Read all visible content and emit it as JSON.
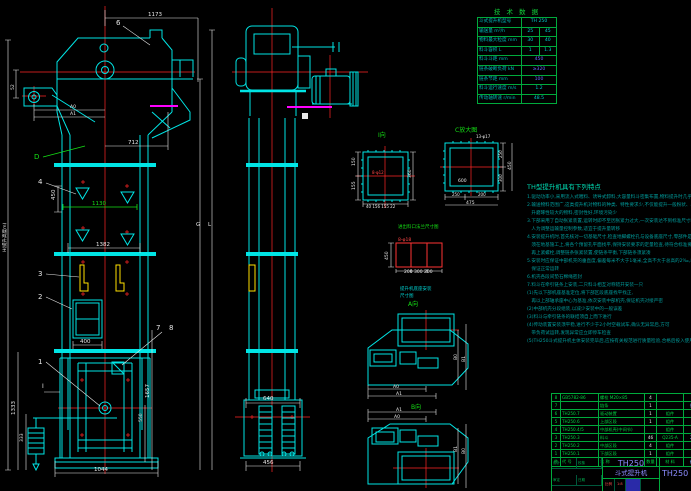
{
  "tech_table": {
    "title": "技 术 数 据",
    "rows": [
      {
        "label": "斗式提升机型号",
        "values": [
          "TH 250"
        ]
      },
      {
        "label": "输送量 m³/h",
        "values": [
          "25",
          "45"
        ]
      },
      {
        "label": "物料最大粒度 mm",
        "values": [
          "30",
          "40"
        ]
      },
      {
        "label": "料斗容积 L",
        "values": [
          "1",
          "1.3"
        ]
      },
      {
        "label": "料斗斗距 mm",
        "values": [
          "450"
        ]
      },
      {
        "label": "链条破断负荷 kN",
        "values": [
          "≥320"
        ]
      },
      {
        "label": "链条节距 mm",
        "values": [
          "100"
        ]
      },
      {
        "label": "料斗运行速度 m/s",
        "values": [
          "1.2"
        ]
      },
      {
        "label": "传动轴转速 r/min",
        "values": [
          "48.5"
        ]
      }
    ]
  },
  "notes": {
    "title": "TH型提升机具有下列特点",
    "lines": [
      "1.驱动功率小,采用流入式喂料、诱导式卸料,大容量料斗密集布置,物料提升时几乎无回流一般",
      "2.输送物料范围广,这类提升机对物料的种类、特性要求少,不仅能提升一般粉状、小颗粒状物料,而且可提",
      "   升磨琢性较大的物料,密封性好,环境污染少",
      "3.下部采用了自动张紧装置,运转时即不至因张紧力过大,一次安装达不到标准尺寸时,方可进行修正,",
      "   人为调整运输量控制参数,适宜于提升量转移",
      "4.安装提升机时,首先核对一切基础尺寸,检查地脚螺栓孔与设备底座尺寸,零部件是否齐全,附属件安装时",
      "   须在地基施工上,将各个预留孔平面找平,保持安装要求的定量检查,待符合标准要求后方可施工,",
      "   再上紧螺栓,调整链条张紧装置,使链条平衡,下部链条须紧凑",
      "5.安装时应保证中部机壳的垂直度,偏差每米不大于1毫米,全高不大于总高的2‰,以",
      "   保证正常运转",
      "6.机壳各段间垫石棉绳密封",
      "7.料斗在牵引链条上安装,二只料斗相互对称错开安装一只",
      "",
      "(1)先以下部机座基准定位,将下部区段底座找平找正,",
      "   再以上部轴承座中心为基准,依次安装中部机壳,保证机壳对接严密",
      "(2)中部机壳分段组装,以减少安装中的一般误差",
      "(3)料斗与牵引链条的联结须自上而下进行",
      "(4)传动装置安装须平稳,进行不少于2小时空载试车,确认无异常后,方可",
      "   带负荷试运转,发现异常应立即停车检查",
      "",
      "(5)TH250斗式提升机主体安装完毕后,应按有关规范进行质量检验,合格后投入使用."
    ]
  },
  "bom": {
    "headers": {
      "no": "件号",
      "code": "代  号",
      "name": "名  称",
      "qty": "数量",
      "mat": "材  料",
      "note": "备注"
    },
    "rows": [
      {
        "no": "8",
        "code": "GB5782-86",
        "name": "螺栓 M20×85",
        "qty": "4",
        "mat": "",
        "note": ""
      },
      {
        "no": "7",
        "code": "",
        "name": "链条",
        "qty": "1",
        "mat": "",
        "note": "外购"
      },
      {
        "no": "6",
        "code": "TH250.7",
        "name": "驱动装置",
        "qty": "1",
        "mat": "组件",
        "note": ""
      },
      {
        "no": "5",
        "code": "TH250.6",
        "name": "上部区段",
        "qty": "1",
        "mat": "组件",
        "note": ""
      },
      {
        "no": "4",
        "code": "TH250.4/5",
        "name": "中部机壳(中间节)",
        "qty": "",
        "mat": "组件",
        "note": ""
      },
      {
        "no": "3",
        "code": "TH250.3",
        "name": "料斗",
        "qty": "46",
        "mat": "Q235-A",
        "note": "205"
      },
      {
        "no": "2",
        "code": "TH250.2",
        "name": "中部区段",
        "qty": "4",
        "mat": "组件",
        "note": ""
      },
      {
        "no": "1",
        "code": "TH250.1",
        "name": "下部区段",
        "qty": "1",
        "mat": "组件",
        "note": ""
      }
    ]
  },
  "title_block": {
    "model": "TH250",
    "name": "斗式提升机",
    "drawing_no": "TH250",
    "scale_label": "比例",
    "scale_value": "1:8",
    "sig": [
      "设计",
      "校核",
      "审定",
      "日期"
    ]
  },
  "drawing": {
    "d1173": "1173",
    "n6": "6",
    "a0": "A0",
    "a1": "A1",
    "v52": "52",
    "nD": "D",
    "d712": "712",
    "n4": "4",
    "d450": "450",
    "d1130": "1130",
    "d1382": "1382",
    "n3": "3",
    "n2": "2",
    "d400": "400",
    "n7": "7",
    "n8": "8",
    "n1": "1",
    "sectI": "I",
    "d1333": "1333",
    "d333": "333",
    "d1657": "1657",
    "d550": "550",
    "d1044": "1044",
    "h_label": "H(提升高度m)",
    "g": "G",
    "l": "L",
    "d640": "640",
    "d456": "456",
    "view_i": "I向",
    "det1_left1": "150",
    "det1_left2": "155",
    "det1_right": "360",
    "det1_bottom": "40 156 155 22",
    "det1_call": "8-φ12",
    "view_c": "C放大图",
    "det2_call": "13-φ17",
    "det2_600": "600",
    "det2_b1": "250",
    "det2_b2": "200",
    "det2_b_total": "475",
    "det2_r1": "250",
    "det2_r2": "300",
    "det2_r_total": "450",
    "caption_flange": "进出料口法兰尺寸图",
    "det3_call": "8-φ18",
    "det3_left": "450",
    "det3_bottom": "200 300 200",
    "caption_base1": "提升机底座安装",
    "caption_base2": "尺寸图",
    "view_a": "A向",
    "view_b": "B向",
    "p1_a0": "A0",
    "p1_a1": "A1",
    "p1_b0": "B0",
    "p1_b1": "B1",
    "p2_a1": "A1",
    "p2_a0": "A0",
    "p2_b1": "B1",
    "p2_b0": "B0"
  }
}
